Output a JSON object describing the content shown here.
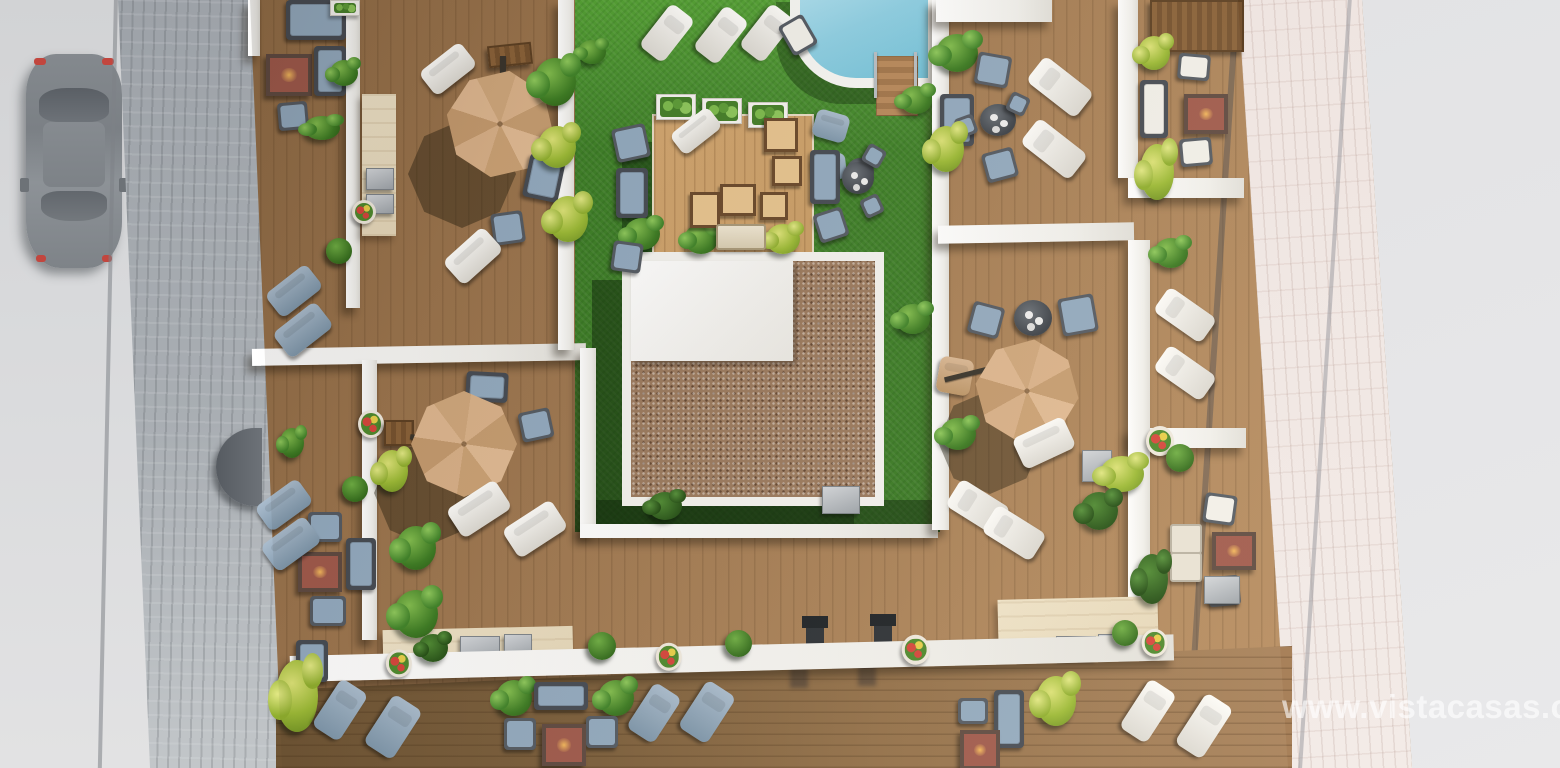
{
  "scene": {
    "description": "Aerial 3D render of a rooftop solarium: wooden sun decks with parasols, loungers and fire-pit lounges around a central lawn courtyard, swimming pool, gravel-roof core, street with parked car on the left and pedestrian pavement on the right",
    "watermark": "www.vistacasas.com"
  },
  "palette": {
    "road": "#d6d7d9",
    "sidewalk": "#a9aeb3",
    "pavement": "#e2e3e5",
    "paver_strip": "#f0e7e3",
    "deck": "#a87f54",
    "deck_dark": "#6e5434",
    "deck_platform": "#c99d66",
    "grass": "#3f8128",
    "grass_light": "#55a235",
    "grass_shadow": "#1e4012",
    "pool_water": "#74c3da",
    "pool_water_light": "#abdeee",
    "wall_white": "#f4f3ef",
    "travertine": "#e6d8ba",
    "gravel_roof": "#9b7a5e",
    "parasol": "#cfa77c",
    "cushion_blue": "#93aabf",
    "lounger_white": "#f3f1ec",
    "fire_pit": "#a05a4c",
    "car_body": "#82878c"
  }
}
